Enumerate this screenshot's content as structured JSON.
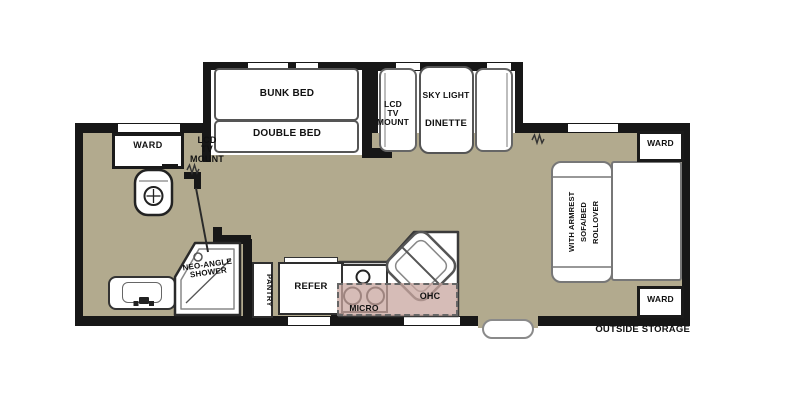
{
  "colors": {
    "floor": "#b2aa8e",
    "wall": "#171717",
    "overhead_cabinet": "rgba(200,165,159,0.75)",
    "furniture_fill": "#ffffff",
    "background": "#ffffff"
  },
  "bedroom": {
    "bunk_bed_label": "BUNK BED",
    "double_bed_label": "DOUBLE BED"
  },
  "bathroom": {
    "ward_label": "WARD",
    "lcd_tv_mount_lines": [
      "LCD",
      "TV",
      "MOUNT"
    ],
    "shower_lines": [
      "NEO-ANGLE",
      "SHOWER"
    ]
  },
  "dinette": {
    "lcd_tv_mount_lines": [
      "LCD",
      "TV",
      "MOUNT"
    ],
    "sky_light_label": "SKY LIGHT",
    "dinette_label": "DINETTE"
  },
  "kitchen": {
    "pantry_label": "PANTRY",
    "refer_label": "REFER",
    "micro_label": "MICRO",
    "ohc_label": "OHC"
  },
  "living": {
    "sofa_lines": [
      "ROLLOVER",
      "SOFA/BED",
      "WITH ARMREST"
    ],
    "ward_top_label": "WARD",
    "ward_bottom_label": "WARD"
  },
  "exterior": {
    "outside_storage_label": "OUTSIDE STORAGE"
  }
}
